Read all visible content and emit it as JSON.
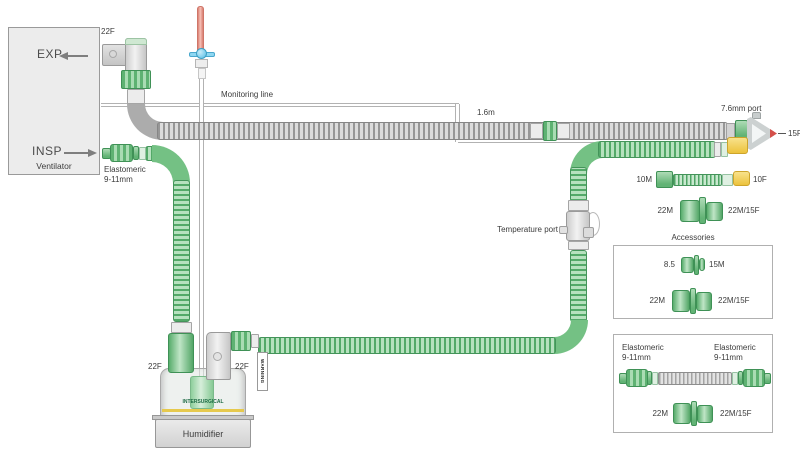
{
  "ventilator": {
    "exp": "EXP",
    "insp": "INSP",
    "name": "Ventilator",
    "exp_port": "22F",
    "insp_elastomeric_line1": "Elastomeric",
    "insp_elastomeric_line2": "9-11mm"
  },
  "circuit": {
    "monitoring_line": "Monitoring line",
    "length": "1.6m",
    "y_piece_port": "7.6mm port",
    "patient_end": "15F",
    "temperature_port": "Temperature port"
  },
  "adapters": {
    "m10": "10M",
    "f10": "10F",
    "m22": "22M",
    "m22_f15": "22M/15F"
  },
  "humidifier": {
    "label": "Humidifier",
    "brand": "INTERSURGICAL",
    "inlet_port": "22F",
    "outlet_port": "22F",
    "warning": "WARNING"
  },
  "accessories_box": {
    "title": "Accessories",
    "row1_left": "8.5",
    "row1_right": "15M",
    "row2_left": "22M",
    "row2_right": "22M/15F"
  },
  "catheter_mount_box": {
    "left_line1": "Elastomeric",
    "left_line2": "9-11mm",
    "right_line1": "Elastomeric",
    "right_line2": "9-11mm",
    "adapter_left": "22M",
    "adapter_right": "22M/15F"
  },
  "colors": {
    "circuit_green": "#6ab97c",
    "tube_gray": "#b3b3b3",
    "connector_yellow": "#f0ce52",
    "monitoring_red": "#e08a7d",
    "stopcock_blue": "#6cc6e8"
  }
}
